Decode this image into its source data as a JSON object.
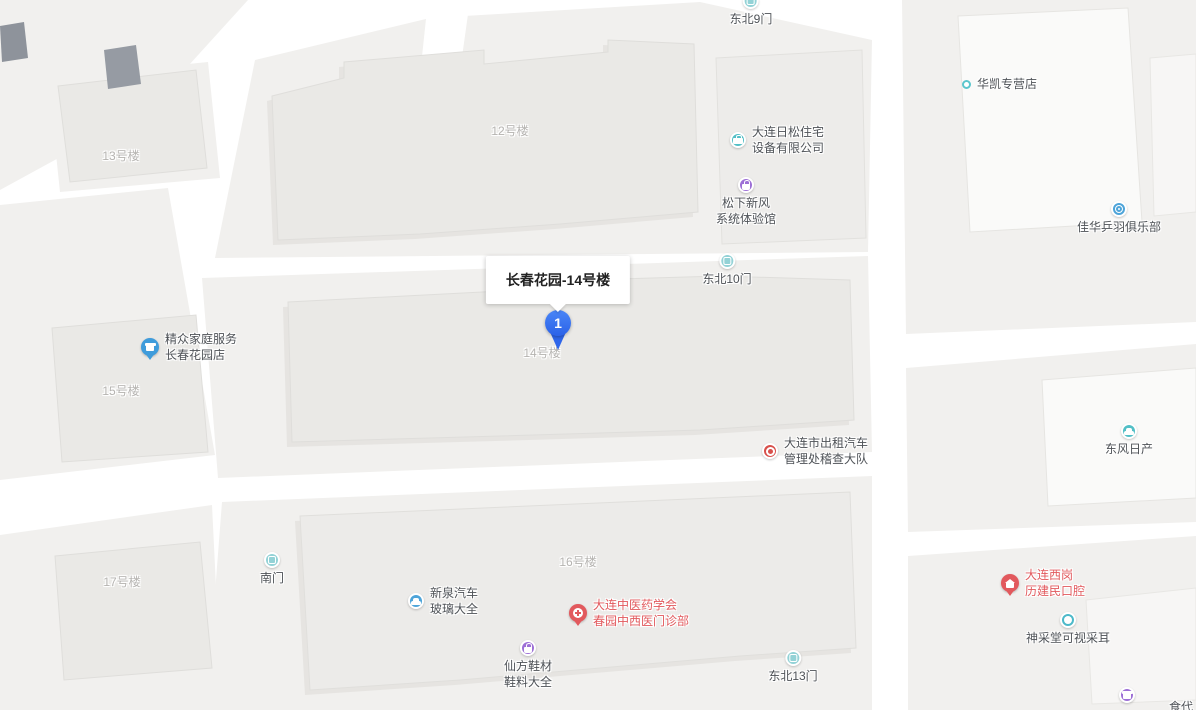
{
  "map": {
    "callout": {
      "title": "长春花园-14号楼",
      "pin_label": "1"
    },
    "colors": {
      "accent_red": "#e2595d",
      "poi_text": "#4e5257",
      "muted_text": "#b5b3b0",
      "pin_blue": "#2f66ea",
      "gate_teal": "#93d2d6",
      "teal": "#52bfc6",
      "purple": "#9d6fd6",
      "blue": "#4da4d9",
      "blue_drop": "#3f9cdb",
      "red_circle": "#d8504b",
      "road_white": "#ffffff",
      "block_gray": "#f1f0ee",
      "building_gray": "#eae9e6",
      "dark_building": "#8e939b"
    },
    "pois": [
      {
        "id": "gate-dongbei-9",
        "icon": "gate",
        "icon_color": "#93d2d6",
        "layout": "icon-top",
        "x": 751,
        "y": 3,
        "lines": [
          "东北9门"
        ]
      },
      {
        "id": "huakai-store",
        "icon": "dot",
        "icon_color": "#5bc6cd",
        "layout": "icon-left",
        "x": 972,
        "y": 84,
        "lines": [
          "华凯专营店"
        ]
      },
      {
        "id": "bldg-label-13",
        "icon": "none",
        "icon_color": "",
        "layout": "plain",
        "x": 121,
        "y": 156,
        "lines": [
          "13号楼"
        ],
        "muted": true
      },
      {
        "id": "bldg-label-12",
        "icon": "none",
        "icon_color": "",
        "layout": "plain",
        "x": 510,
        "y": 131,
        "lines": [
          "12号楼"
        ],
        "muted": true
      },
      {
        "id": "risong-company",
        "icon": "briefcase",
        "icon_color": "#52bfc6",
        "layout": "icon-left",
        "x": 740,
        "y": 140,
        "lines": [
          "大连日松住宅",
          "设备有限公司"
        ]
      },
      {
        "id": "songxia-showroom",
        "icon": "bag",
        "icon_color": "#9d6fd6",
        "layout": "icon-top",
        "x": 746,
        "y": 187,
        "lines": [
          "松下新风",
          "系统体验馆"
        ]
      },
      {
        "id": "jiahua-club",
        "icon": "sports",
        "icon_color": "#4da4d9",
        "layout": "icon-top",
        "x": 1119,
        "y": 211,
        "lines": [
          "佳华乒羽俱乐部"
        ]
      },
      {
        "id": "gate-dongbei-10",
        "icon": "gate",
        "icon_color": "#93d2d6",
        "layout": "icon-top",
        "x": 727,
        "y": 263,
        "lines": [
          "东北10门"
        ]
      },
      {
        "id": "jingzhong-service",
        "icon": "store-drop",
        "icon_color": "#3f9cdb",
        "layout": "icon-left",
        "x": 151,
        "y": 347,
        "lines": [
          "精众家庭服务",
          "长春花园店"
        ]
      },
      {
        "id": "bldg-label-15",
        "icon": "none",
        "icon_color": "",
        "layout": "plain",
        "x": 121,
        "y": 391,
        "lines": [
          "15号楼"
        ],
        "muted": true
      },
      {
        "id": "bldg-label-14",
        "icon": "none",
        "icon_color": "",
        "layout": "plain",
        "x": 542,
        "y": 353,
        "lines": [
          "14号楼"
        ],
        "muted": true
      },
      {
        "id": "taxi-admin",
        "icon": "gov",
        "icon_color": "#d8504b",
        "layout": "icon-left",
        "x": 772,
        "y": 451,
        "lines": [
          "大连市出租汽车",
          "管理处稽查大队"
        ]
      },
      {
        "id": "dongfeng-nissan",
        "icon": "car",
        "icon_color": "#52bfc6",
        "layout": "icon-top",
        "x": 1129,
        "y": 433,
        "lines": [
          "东风日产"
        ]
      },
      {
        "id": "bldg-label-16",
        "icon": "none",
        "icon_color": "",
        "layout": "plain",
        "x": 578,
        "y": 562,
        "lines": [
          "16号楼"
        ],
        "muted": true
      },
      {
        "id": "gate-south",
        "icon": "gate",
        "icon_color": "#93d2d6",
        "layout": "icon-top",
        "x": 272,
        "y": 562,
        "lines": [
          "南门"
        ]
      },
      {
        "id": "bldg-label-17",
        "icon": "none",
        "icon_color": "",
        "layout": "plain",
        "x": 122,
        "y": 582,
        "lines": [
          "17号楼"
        ],
        "muted": true
      },
      {
        "id": "xinquan-glass",
        "icon": "car",
        "icon_color": "#4da4d9",
        "layout": "icon-left",
        "x": 418,
        "y": 601,
        "lines": [
          "新泉汽车",
          "玻璃大全"
        ]
      },
      {
        "id": "zhongyiyao-clinic",
        "icon": "med-drop",
        "icon_color": "#e2595d",
        "layout": "icon-left",
        "x": 579,
        "y": 613,
        "lines": [
          "大连中医药学会",
          "春园中西医门诊部"
        ],
        "accent": true
      },
      {
        "id": "xigang-dental",
        "icon": "house-drop",
        "icon_color": "#e2595d",
        "layout": "icon-left",
        "x": 1011,
        "y": 583,
        "lines": [
          "大连西岗",
          "历建民口腔"
        ],
        "accent": true
      },
      {
        "id": "shencaitang-ear",
        "icon": "ear",
        "icon_color": "#4cb9c9",
        "layout": "icon-top",
        "x": 1068,
        "y": 622,
        "lines": [
          "神采堂可视采耳"
        ]
      },
      {
        "id": "xianfang-shoes",
        "icon": "bag",
        "icon_color": "#9d6fd6",
        "layout": "icon-top",
        "x": 528,
        "y": 650,
        "lines": [
          "仙方鞋材",
          "鞋料大全"
        ]
      },
      {
        "id": "gate-dongbei-13",
        "icon": "gate",
        "icon_color": "#93d2d6",
        "layout": "icon-top",
        "x": 793,
        "y": 660,
        "lines": [
          "东北13门"
        ]
      },
      {
        "id": "shidai-store-icon",
        "icon": "storefront",
        "icon_color": "#9d6fd6",
        "layout": "icon-top",
        "x": 1127,
        "y": 697,
        "lines": []
      },
      {
        "id": "shidai-store-label",
        "icon": "none",
        "icon_color": "",
        "layout": "plain",
        "x": 1181,
        "y": 707,
        "lines": [
          "食代"
        ]
      }
    ]
  }
}
